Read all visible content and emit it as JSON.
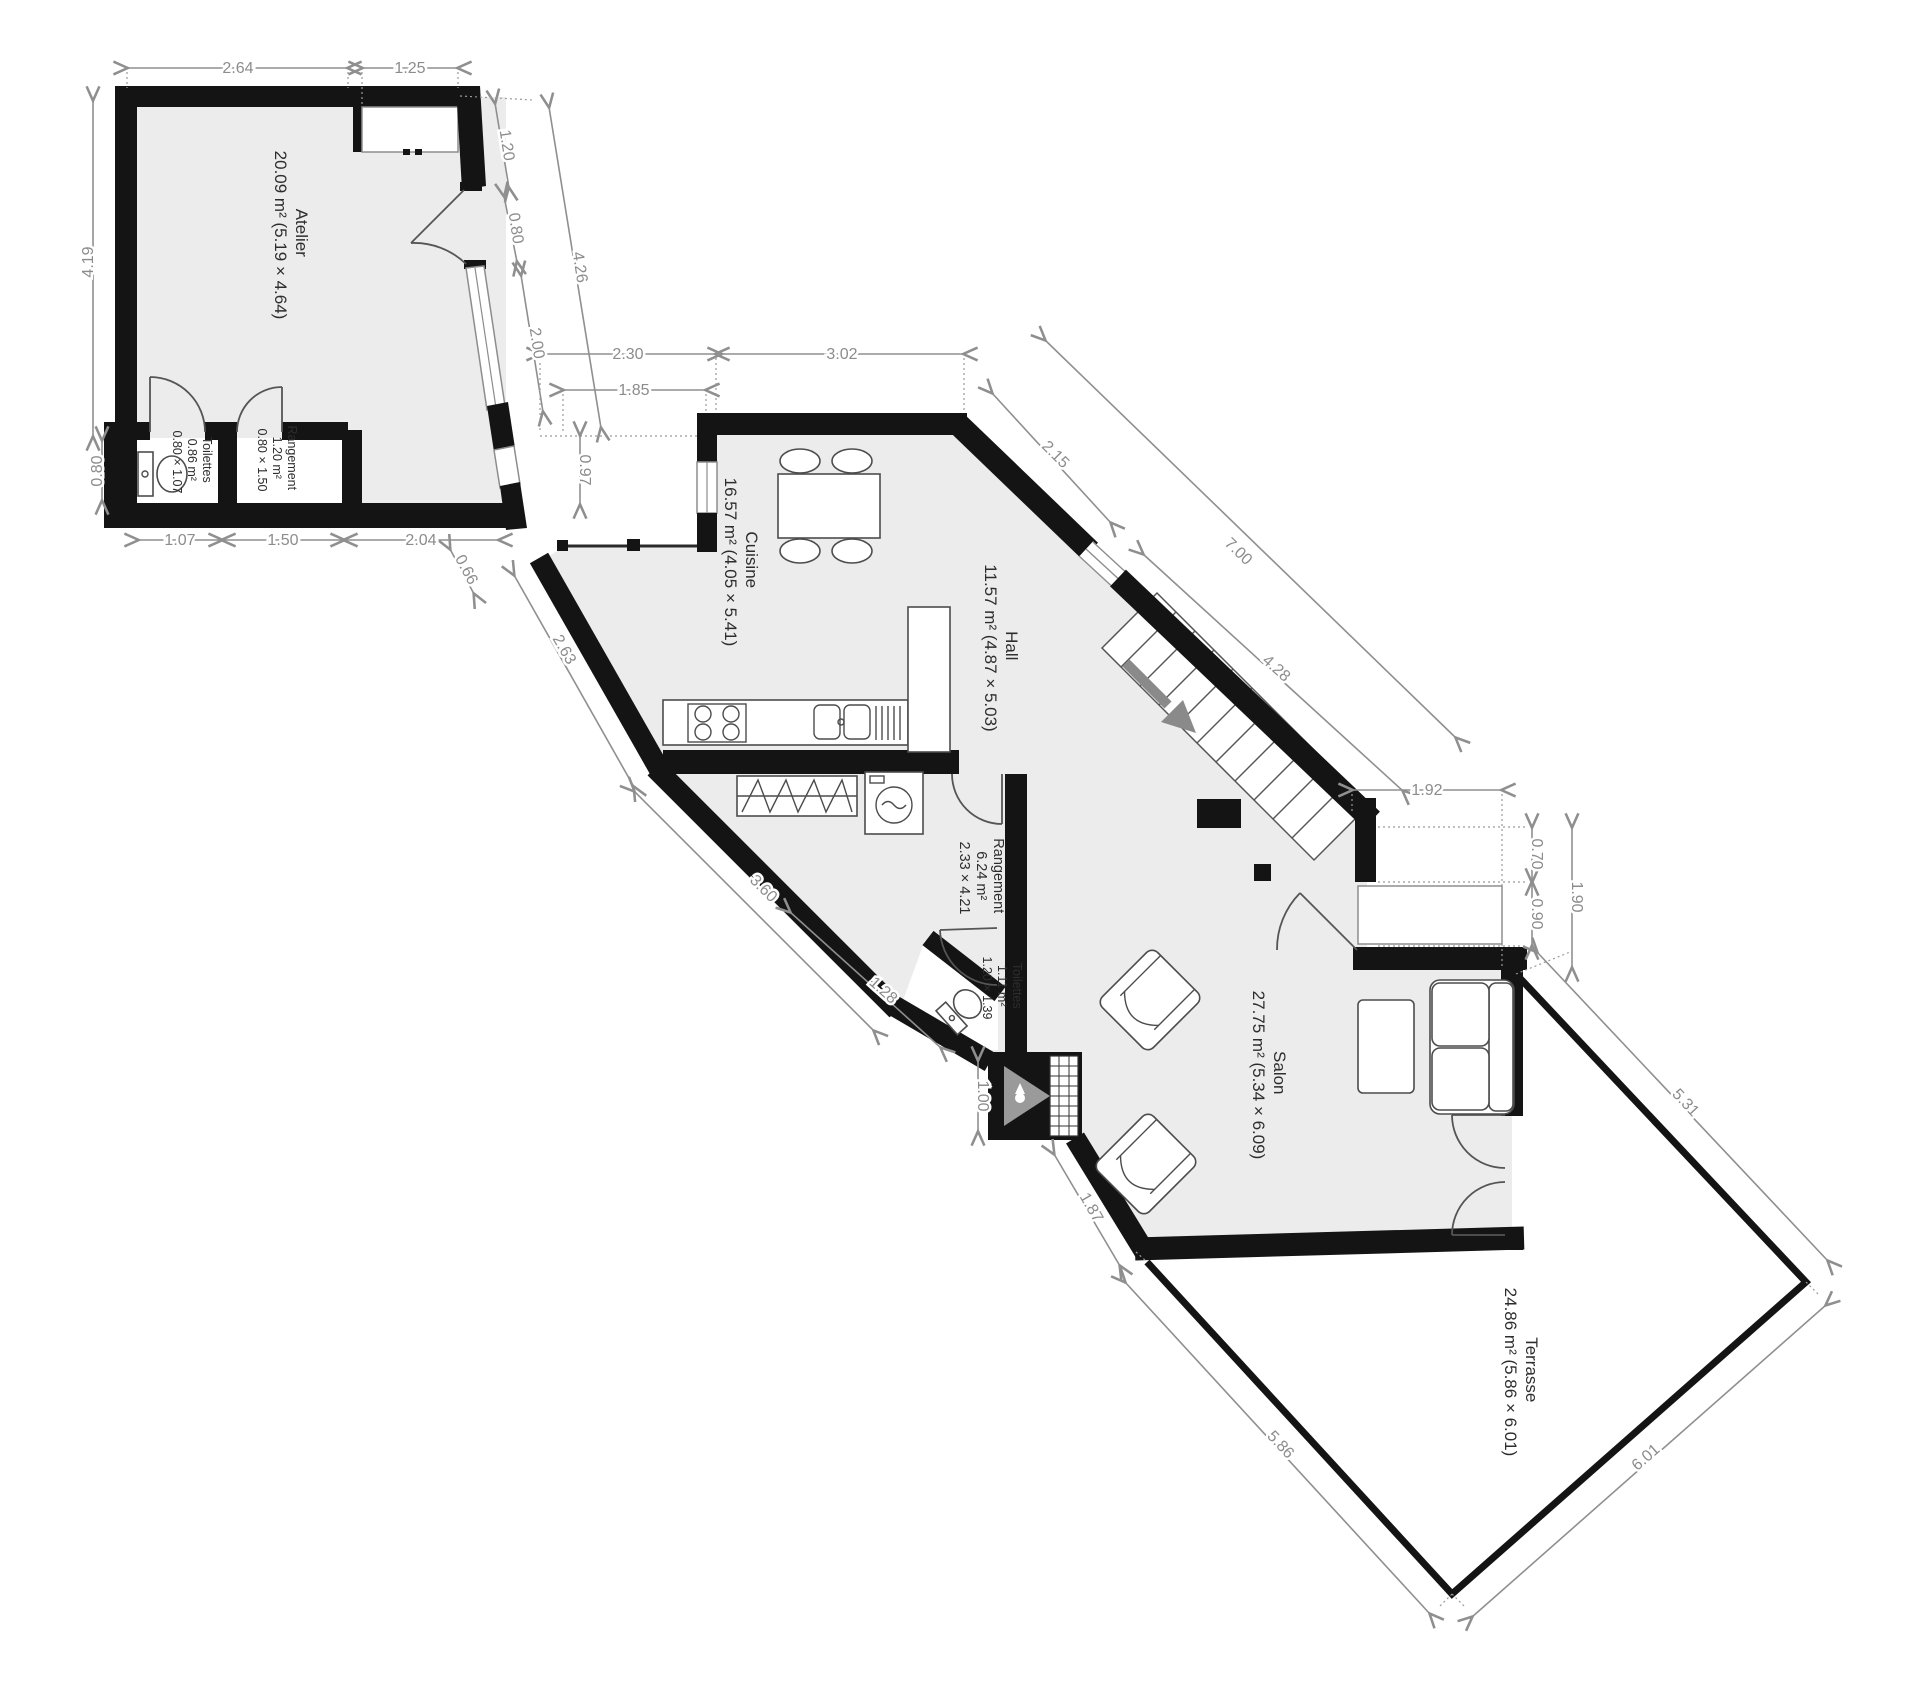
{
  "plan_title": "Floor plan ground floor",
  "colors": {
    "wall": "#141414",
    "floor": "#ececec",
    "dimension": "#8c8c8c",
    "furniture_stroke": "#4c4c4c",
    "stairs_arrow": "#8a8a8a",
    "fireplace_grey": "#9a9a9a"
  },
  "rooms": {
    "atelier": {
      "name": "Atelier",
      "details": "20.09 m² (5.19 × 4.64)"
    },
    "toilettes_a": {
      "name": "Toilettes",
      "area": "0.86 m²",
      "size": "0.80 × 1.07"
    },
    "rangement_a": {
      "name": "Rangement",
      "area": "1.20 m²",
      "size": "0.80 × 1.50"
    },
    "cuisine": {
      "name": "Cuisine",
      "details": "16.57 m² (4.05 × 5.41)"
    },
    "hall": {
      "name": "Hall",
      "details": "11.57 m² (4.87 × 5.03)"
    },
    "rangement": {
      "name": "Rangement",
      "area": "6.24 m²",
      "size": "2.33 × 4.21"
    },
    "toilettes": {
      "name": "Toilettes",
      "area": "1.11 m²",
      "size": "1.20 × 1.39"
    },
    "salon": {
      "name": "Salon",
      "details": "27.75 m² (5.34 × 6.09)"
    },
    "terrasse": {
      "name": "Terrasse",
      "details": "24.86 m² (5.86 × 6.01)"
    }
  },
  "dims": [
    "2.64",
    "1.25",
    "4.19",
    "0.80",
    "1.20",
    "0.80",
    "4.26",
    "2.00",
    "2.30",
    "1.85",
    "3.02",
    "0.97",
    "1.07",
    "1.50",
    "2.04",
    "0.66",
    "2.63",
    "3.60",
    "1.28",
    "1.00",
    "1.87",
    "2.15",
    "7.00",
    "4.28",
    "1.92",
    "0.70",
    "0.90",
    "1.90",
    "5.31",
    "5.86",
    "6.01"
  ]
}
